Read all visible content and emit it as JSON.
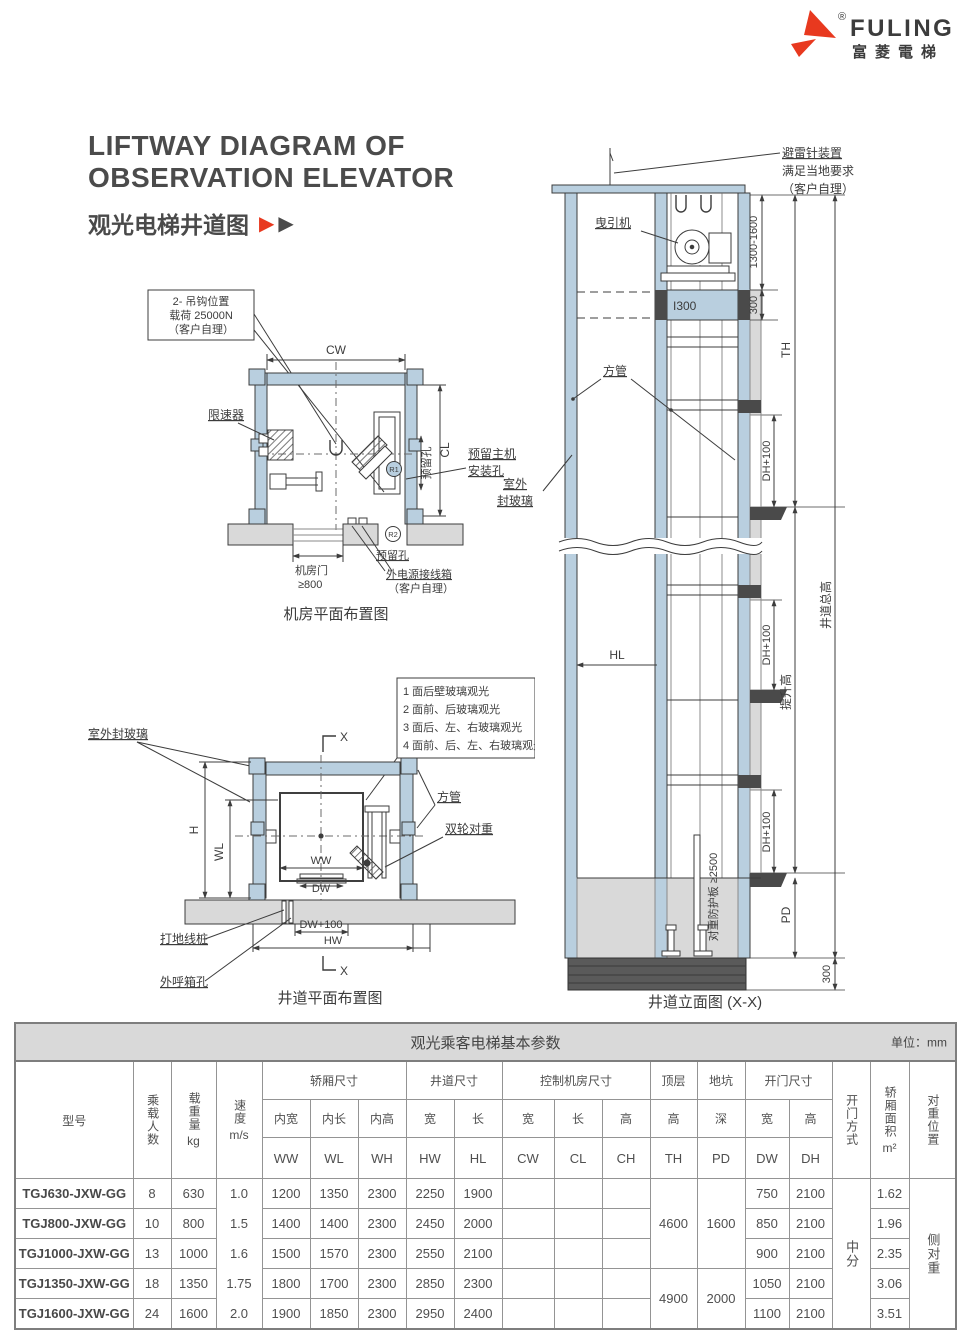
{
  "brand": {
    "name": "FULING",
    "chinese": "富菱電梯",
    "registered": "®"
  },
  "header": {
    "title_line1": "LIFTWAY DIAGRAM OF",
    "title_line2": "OBSERVATION ELEVATOR",
    "subtitle": "观光电梯井道图",
    "arrow1": "▶",
    "arrow2": "▶"
  },
  "colors": {
    "accent_red": "#e8391f",
    "wall_blue": "#b9cfdf",
    "slab_gray": "#d9d9d9",
    "dark": "#4a4a4a"
  },
  "diagrams": {
    "machine_room": {
      "caption": "机房平面布置图",
      "hook_note": [
        "2- 吊钩位置",
        "载荷 25000N",
        "（客户自理）"
      ],
      "governor": "限速器",
      "cw": "CW",
      "cl": "CL",
      "reserved_main": [
        "预留主机",
        "安装孔"
      ],
      "reserved_hole_side": "预留孔",
      "reserved_hole_bottom": "预留孔",
      "r1": "R1",
      "r2": "R2",
      "door_label": "机房门",
      "door_dim": "≥800",
      "power_box": [
        "外电源接线箱",
        "（客户自理）"
      ]
    },
    "shaft_plan": {
      "caption": "井道平面布置图",
      "outdoor_glass": "室外封玻璃",
      "x_top": "X",
      "x_bottom": "X",
      "notes": [
        "1 面后壁玻璃观光",
        "2 面前、后玻璃观光",
        "3 面后、左、右玻璃观光",
        "4 面前、后、左、右玻璃观光"
      ],
      "square_tube": "方管",
      "double_wheel_cwt": "双轮对重",
      "h": "H",
      "wl": "WL",
      "ww": "WW",
      "dw": "DW",
      "dw100": "DW+100",
      "hw": "HW",
      "ground_wire": "打地线桩",
      "call_box": "外呼箱孔"
    },
    "elevation": {
      "caption": "井道立面图 (X-X)",
      "lightning": [
        "避雷针装置",
        "满足当地要求",
        "（客户自理）"
      ],
      "traction_machine": "曳引机",
      "dim_top": "1300-1600",
      "beam": "I300",
      "dim_300_top": "300",
      "th": "TH",
      "square_tube": "方管",
      "outdoor_glass": [
        "室外",
        "封玻璃"
      ],
      "hl": "HL",
      "dh1": "DH+100",
      "dh2": "DH+100",
      "dh3": "DH+100",
      "total_height": "井道总高",
      "travel_height": "提升高",
      "cwt_guard": "对重防护板 ≥2500",
      "pd": "PD",
      "dim_300_bottom": "300"
    }
  },
  "table": {
    "title": "观光乘客电梯基本参数",
    "unit": "单位：mm",
    "groups": {
      "car": "轿厢尺寸",
      "shaft": "井道尺寸",
      "machine_room": "控制机房尺寸",
      "top": "顶层",
      "pit": "地坑",
      "door": "开门尺寸"
    },
    "cols": {
      "model": "型号",
      "persons": "乘载人数",
      "load": "载重量",
      "load_unit": "kg",
      "speed": "速度",
      "speed_unit": "m/s",
      "inner_w": "内宽",
      "inner_l": "内长",
      "inner_h": "内高",
      "w_shaft": "宽",
      "l_shaft": "长",
      "w_mr": "宽",
      "l_mr": "长",
      "h_mr": "高",
      "h_top": "高",
      "d_pit": "深",
      "w_door": "宽",
      "h_door": "高",
      "door_type": "开门方式",
      "area": "轿厢面积",
      "area_unit": "m²",
      "cwt": "对重位置",
      "ww": "WW",
      "wl": "WL",
      "wh": "WH",
      "hw": "HW",
      "hl": "HL",
      "cw": "CW",
      "cl": "CL",
      "ch": "CH",
      "th": "TH",
      "pd": "PD",
      "dw": "DW",
      "dh": "DH"
    },
    "merged": {
      "th_a": "4600",
      "th_b": "4900",
      "pd_a": "1600",
      "pd_b": "2000",
      "door_type": "中分",
      "cwt": "侧对重"
    },
    "rows": [
      {
        "model": "TGJ630-JXW-GG",
        "persons": "8",
        "load": "630",
        "speed": "1.0",
        "ww": "1200",
        "wl": "1350",
        "wh": "2300",
        "hw": "2250",
        "hl": "1900",
        "cw": "",
        "cl": "",
        "ch": "",
        "dw": "750",
        "dh": "2100",
        "area": "1.62"
      },
      {
        "model": "TGJ800-JXW-GG",
        "persons": "10",
        "load": "800",
        "speed": "1.5",
        "ww": "1400",
        "wl": "1400",
        "wh": "2300",
        "hw": "2450",
        "hl": "2000",
        "cw": "",
        "cl": "",
        "ch": "",
        "dw": "850",
        "dh": "2100",
        "area": "1.96"
      },
      {
        "model": "TGJ1000-JXW-GG",
        "persons": "13",
        "load": "1000",
        "speed": "1.6",
        "ww": "1500",
        "wl": "1570",
        "wh": "2300",
        "hw": "2550",
        "hl": "2100",
        "cw": "",
        "cl": "",
        "ch": "",
        "dw": "900",
        "dh": "2100",
        "area": "2.35"
      },
      {
        "model": "TGJ1350-JXW-GG",
        "persons": "18",
        "load": "1350",
        "speed": "1.75",
        "ww": "1800",
        "wl": "1700",
        "wh": "2300",
        "hw": "2850",
        "hl": "2300",
        "cw": "",
        "cl": "",
        "ch": "",
        "dw": "1050",
        "dh": "2100",
        "area": "3.06"
      },
      {
        "model": "TGJ1600-JXW-GG",
        "persons": "24",
        "load": "1600",
        "speed": "2.0",
        "ww": "1900",
        "wl": "1850",
        "wh": "2300",
        "hw": "2950",
        "hl": "2400",
        "cw": "",
        "cl": "",
        "ch": "",
        "dw": "1100",
        "dh": "2100",
        "area": "3.51"
      }
    ]
  }
}
